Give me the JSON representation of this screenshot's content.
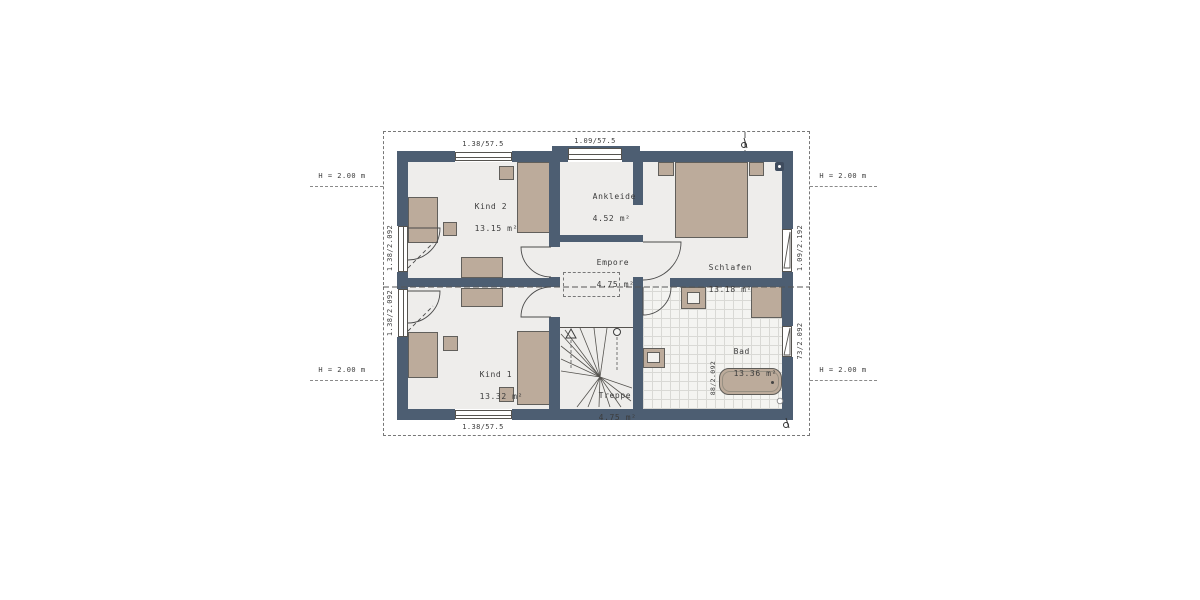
{
  "plan": {
    "rooms": {
      "kind2": {
        "name": "Kind 2",
        "area": "13.15 m²"
      },
      "ankleide": {
        "name": "Ankleide",
        "area": "4.52 m²"
      },
      "schlafen": {
        "name": "Schlafen",
        "area": "13.18 m²"
      },
      "empore": {
        "name": "Empore",
        "area": "4.75 m²"
      },
      "kind1": {
        "name": "Kind 1",
        "area": "13.32 m²"
      },
      "treppe": {
        "name": "Treppe",
        "area": "4.75 m²"
      },
      "bad": {
        "name": "Bad",
        "area": "13.36 m²"
      }
    },
    "dimensions": {
      "window_top_kind2": "1.38/57.5",
      "window_top_ankleide": "1.09/57.5",
      "window_bottom_kind1": "1.38/57.5",
      "door_left_kind2": "1.38/2.092",
      "door_left_kind1": "1.38/2.092",
      "window_right_schlafen": "1.09/2.192",
      "window_right_bad": "73/2.092",
      "bad_interior": "88/2.092"
    },
    "height_markers": {
      "label": "H = 2.00 m"
    },
    "colors": {
      "wall": "#4d5e72",
      "floor": "#eeedeb",
      "furniture": "#bcab9b",
      "tile_line": "#d9d9d5",
      "text": "#3c3c3c"
    }
  }
}
